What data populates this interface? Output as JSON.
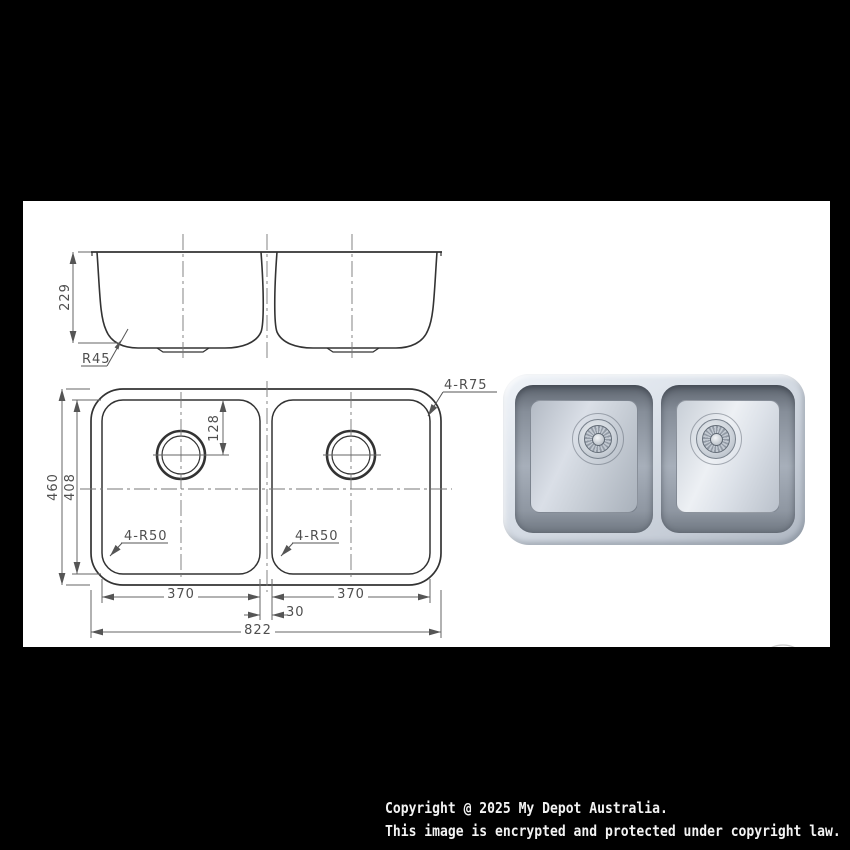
{
  "window": {
    "background": "#000000"
  },
  "sheet": {
    "background": "#ffffff"
  },
  "drawing": {
    "elevation": {
      "depth": "229",
      "radius_label": "R45"
    },
    "plan": {
      "overall_depth": "460",
      "bowl_depth": "408",
      "drain_offset": "128",
      "outer_radius_label": "4-R75",
      "left_bowl_radius_label": "4-R50",
      "right_bowl_radius_label": "4-R50",
      "left_bowl_width": "370",
      "right_bowl_width": "370",
      "divider_width": "30",
      "overall_width": "822"
    }
  },
  "footer": {
    "line1": "Copyright @ 2025 My Depot Australia.",
    "line2": "This image is encrypted and protected under copyright law."
  },
  "colors": {
    "object_line": "#333333",
    "dimension_line": "#666666",
    "centerline": "#777777",
    "dimension_text": "#4f4f4f",
    "steel_light": "#edf1f6",
    "steel_dark": "#aab2bd",
    "footer_text": "#f3f3f3"
  }
}
